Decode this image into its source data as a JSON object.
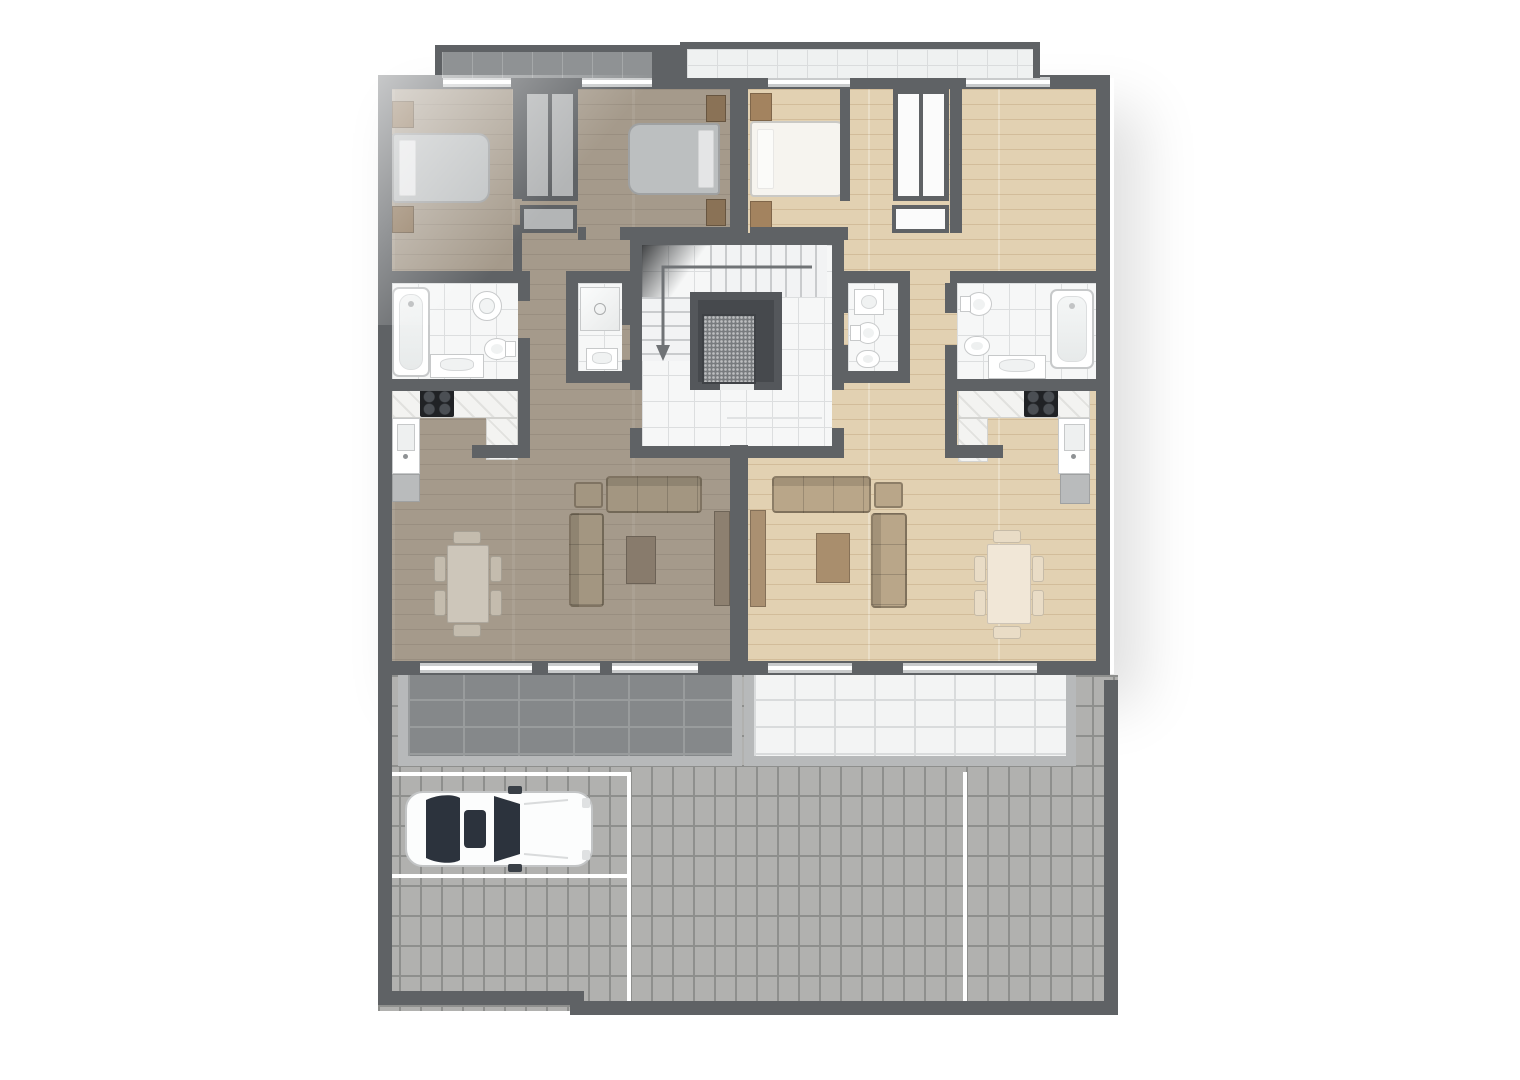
{
  "scene": {
    "kind": "residential-floor-plan",
    "view": "top-down-render",
    "apartments": [
      {
        "id": "apartment-left",
        "floor_finish": "grey-brown-wood",
        "rooms": [
          "bedroom-1",
          "bedroom-2",
          "wardrobe-nook",
          "bathroom",
          "shower-room",
          "kitchen",
          "living-dining-room",
          "hallway",
          "terrace",
          "balcony"
        ],
        "furniture": [
          "double-bed",
          "double-bed",
          "nightstands",
          "wardrobe",
          "bathtub",
          "round-washbasin",
          "toilet",
          "vanity-sink",
          "shower",
          "kitchen-counter",
          "cooktop",
          "kitchen-sink",
          "fridge",
          "dining-table",
          "six-chairs",
          "sofa",
          "chaise-sofa",
          "armchair",
          "coffee-table",
          "tv-sideboard"
        ]
      },
      {
        "id": "apartment-right",
        "floor_finish": "light-oak-wood",
        "rooms": [
          "bedroom",
          "unfurnished-room",
          "wardrobe-nook",
          "bathroom",
          "wc",
          "kitchen",
          "living-dining-room",
          "hallway",
          "terrace",
          "balcony"
        ],
        "furniture": [
          "double-bed",
          "nightstands",
          "wardrobe",
          "bathtub",
          "bidet",
          "toilet",
          "vanity-sink",
          "square-washbasin",
          "kitchen-counter",
          "cooktop",
          "kitchen-sink",
          "fridge",
          "dining-table",
          "six-chairs",
          "sofa",
          "chaise-sofa",
          "armchair",
          "coffee-table",
          "tv-sideboard"
        ]
      }
    ],
    "common_areas": [
      "stairwell",
      "staircase-with-down-arrow",
      "elevator",
      "cobblestone-courtyard",
      "parking-bays-with-white-lines",
      "white-car"
    ]
  },
  "palette": {
    "bg": "#ffffff",
    "wall": "#5f6265",
    "wall_light": "#b7b9ba",
    "window_frame": "#c9cbcc",
    "floor_left": "#a59a8b",
    "floor_right": "#e2d1b2",
    "tile": "#f6f7f7",
    "tile_line": "#dcdedf",
    "balcony_left_tile": "#8f9294",
    "balcony_left_line": "#a5a8a9",
    "balcony_right_tile": "#eff1f1",
    "balcony_right_line": "#dadcdd",
    "terrace_left_tile": "#85888a",
    "terrace_left_line": "#999c9d",
    "terrace_right_tile": "#f3f4f4",
    "terrace_right_line": "#d9dbdc",
    "cobble": "#b1b1af",
    "cobble_line": "#8e8f8d",
    "parking_line": "#ffffff",
    "counter": "#f3f3f1",
    "cooktop": "#202225",
    "appliance": "#b9bbbc",
    "fixture_edge": "#c7c9ca",
    "bed_left": "#bcbfc0",
    "bed_right": "#f6f4ef",
    "night_left": "#8a7256",
    "night_right": "#a3835f",
    "sofa_left": "#a39681",
    "sofa_right": "#b9a689",
    "coffee_left": "#887b6c",
    "coffee_right": "#a98e6d",
    "table_left": "#cdc6ba",
    "table_right": "#f1e7d7",
    "chair_left": "#c4bcae",
    "chair_right": "#e9dcc6",
    "tv_left": "#8d8070",
    "tv_right": "#aa9071",
    "closet_left": "#b3b5b6",
    "closet_right": "#fbfbfb",
    "elevator_frame": "#54575b",
    "elevator_well": "#46494d",
    "elevator_car": "#787b7e",
    "stair_tread": "#f2f3f4",
    "stair_line": "#c9cbcd",
    "arrow": "#707376",
    "car_body": "#fcfdfd",
    "car_glass": "#2c333d"
  }
}
